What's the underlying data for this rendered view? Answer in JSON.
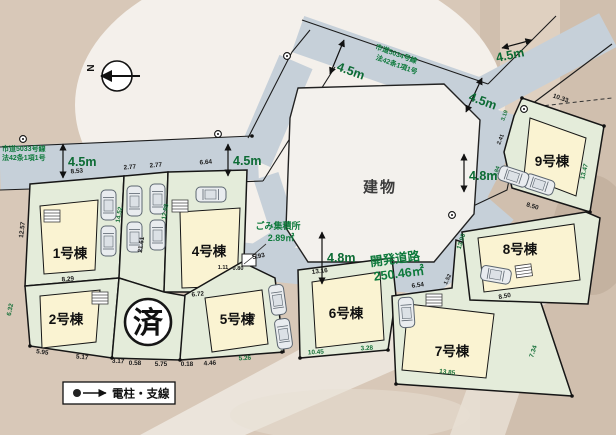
{
  "compass": {
    "north_label": "N"
  },
  "building": {
    "label": "建物"
  },
  "stamp": {
    "sold": "済"
  },
  "legend": {
    "power_pole": "電柱・支線"
  },
  "garbage": {
    "name": "ごみ集積所",
    "area": "2.89㎡"
  },
  "roads": {
    "west": {
      "name": "市道5033号線",
      "law": "法42条1項1号",
      "width": "4.5m",
      "width2": "4.5m"
    },
    "north": {
      "name": "市道5034号線",
      "law": "法42条1項1号",
      "width": "4.5m",
      "width2": "4.5m",
      "width3": "4.5m"
    },
    "development": {
      "name": "開発道路",
      "area": "250.46㎡",
      "width_east": "4.8m",
      "width_south": "4.8m"
    }
  },
  "lots": [
    {
      "label": "1号棟"
    },
    {
      "label": "2号棟"
    },
    {
      "label": "4号棟"
    },
    {
      "label": "5号棟"
    },
    {
      "label": "6号棟"
    },
    {
      "label": "7号棟"
    },
    {
      "label": "8号棟"
    },
    {
      "label": "9号棟"
    }
  ],
  "dims": {
    "lot1_top": "8.53",
    "park_w1": "2.77",
    "park_w2": "2.77",
    "lot4_top": "6.64",
    "lot1_left": "12.57",
    "lot1_bottom": "8.29",
    "lot2_left": "6.32",
    "south_1": "5.95",
    "south_2": "5.17",
    "south_3": "3.17",
    "south_4": "0.58",
    "south_5": "5.75",
    "south_6": "0.18",
    "south_7": "4.46",
    "south_8": "5.26",
    "south_9": "10.45",
    "south_10": "3.28",
    "south_11": "13.85",
    "col_1": "14.52",
    "col_2": "21.61",
    "col_3": "12.88",
    "lot4_bottom": "6.72",
    "lot5_top": "5.93",
    "lot5_right": "7.49",
    "garbage_1": "1.11",
    "garbage_2": "0.80",
    "lot6_top": "13.16",
    "lot7_top": "6.54",
    "lot7_ne": "1.52",
    "lot7_right": "7.34",
    "lot8_left": "13.90",
    "lot8_park": "8.50",
    "lot9_top": "10.33",
    "lot9_left_1": "3.19",
    "lot9_left_2": "2.41",
    "lot9_left_3": "1.84",
    "lot9_bottom": "8.50",
    "lot9_right": "13.47"
  }
}
